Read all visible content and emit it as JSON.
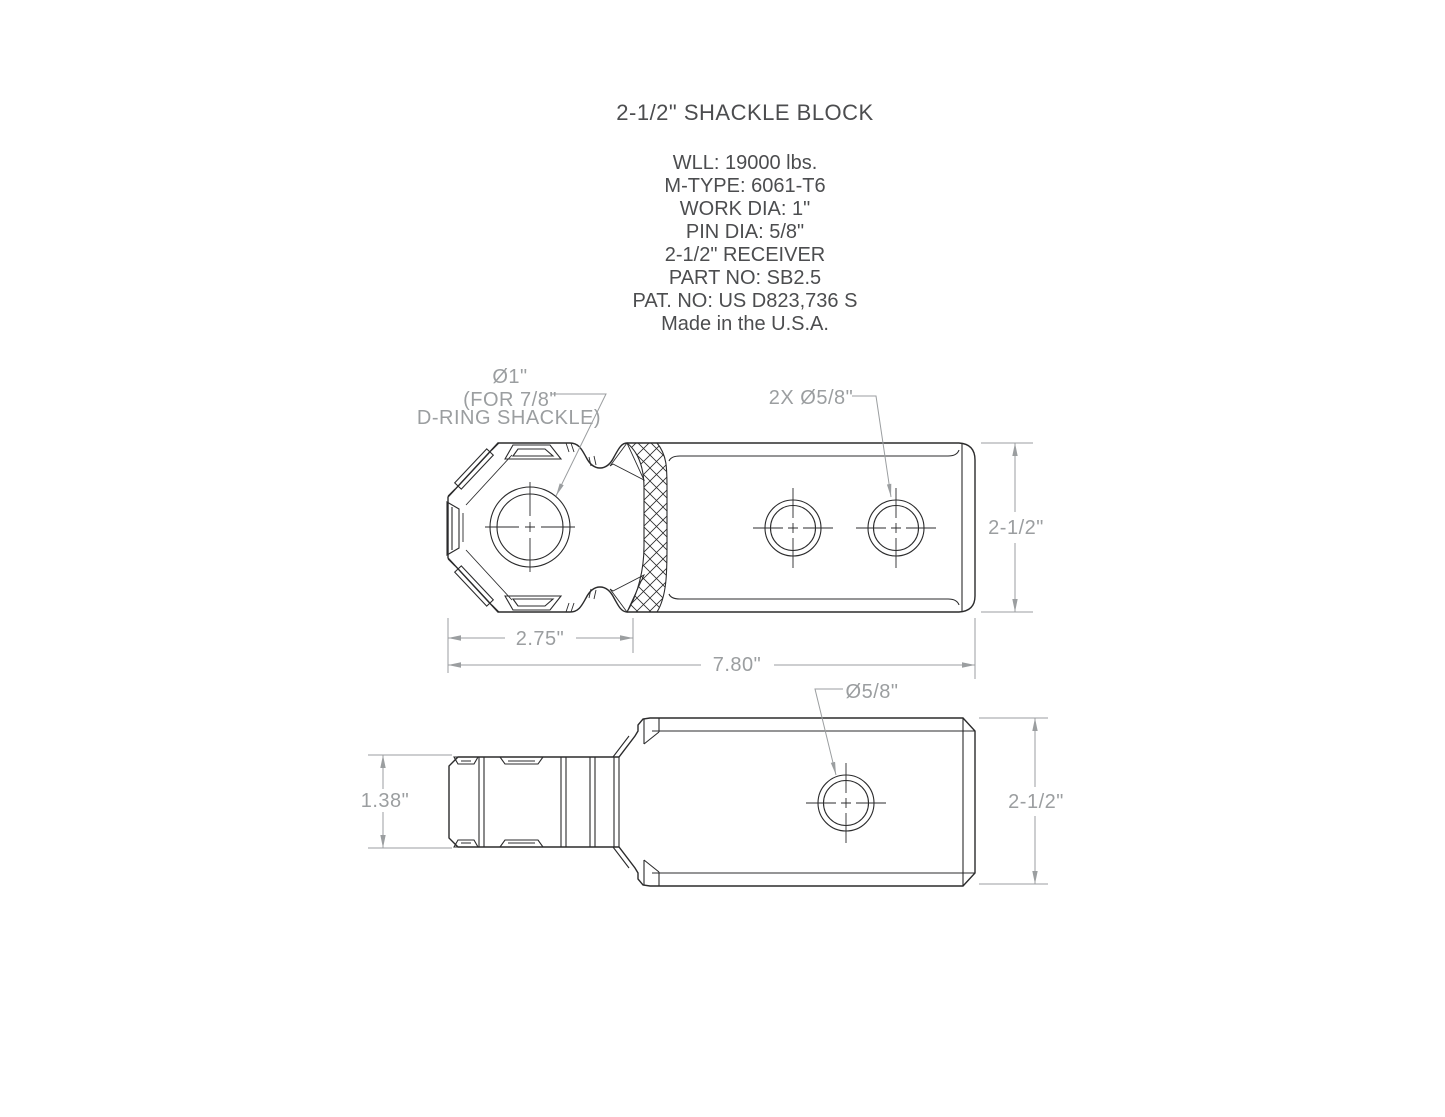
{
  "title": "2-1/2\" SHACKLE BLOCK",
  "specs": [
    "WLL: 19000 lbs.",
    "M-TYPE: 6061-T6",
    "WORK DIA: 1\"",
    "PIN DIA: 5/8\"",
    "2-1/2\" RECEIVER",
    "PART NO: SB2.5",
    "PAT. NO: US D823,736 S",
    "Made in the U.S.A."
  ],
  "annotations": {
    "hole_label_line1": "Ø1\"",
    "hole_label_line2": "(FOR 7/8\"",
    "hole_label_line3": "D-RING SHACKLE)",
    "pin_holes_label": "2X Ø5/8\"",
    "side_hole_label": "Ø5/8\""
  },
  "dimensions": {
    "top_height": "2-1/2\"",
    "mount_length": "2.75\"",
    "overall_length": "7.80\"",
    "side_mount_height": "1.38\"",
    "side_height": "2-1/2\""
  },
  "colors": {
    "background": "#ffffff",
    "part_outline": "#2b2b2c",
    "dimension_gray": "#9b9ea0",
    "header_text": "#4c4d4f"
  }
}
